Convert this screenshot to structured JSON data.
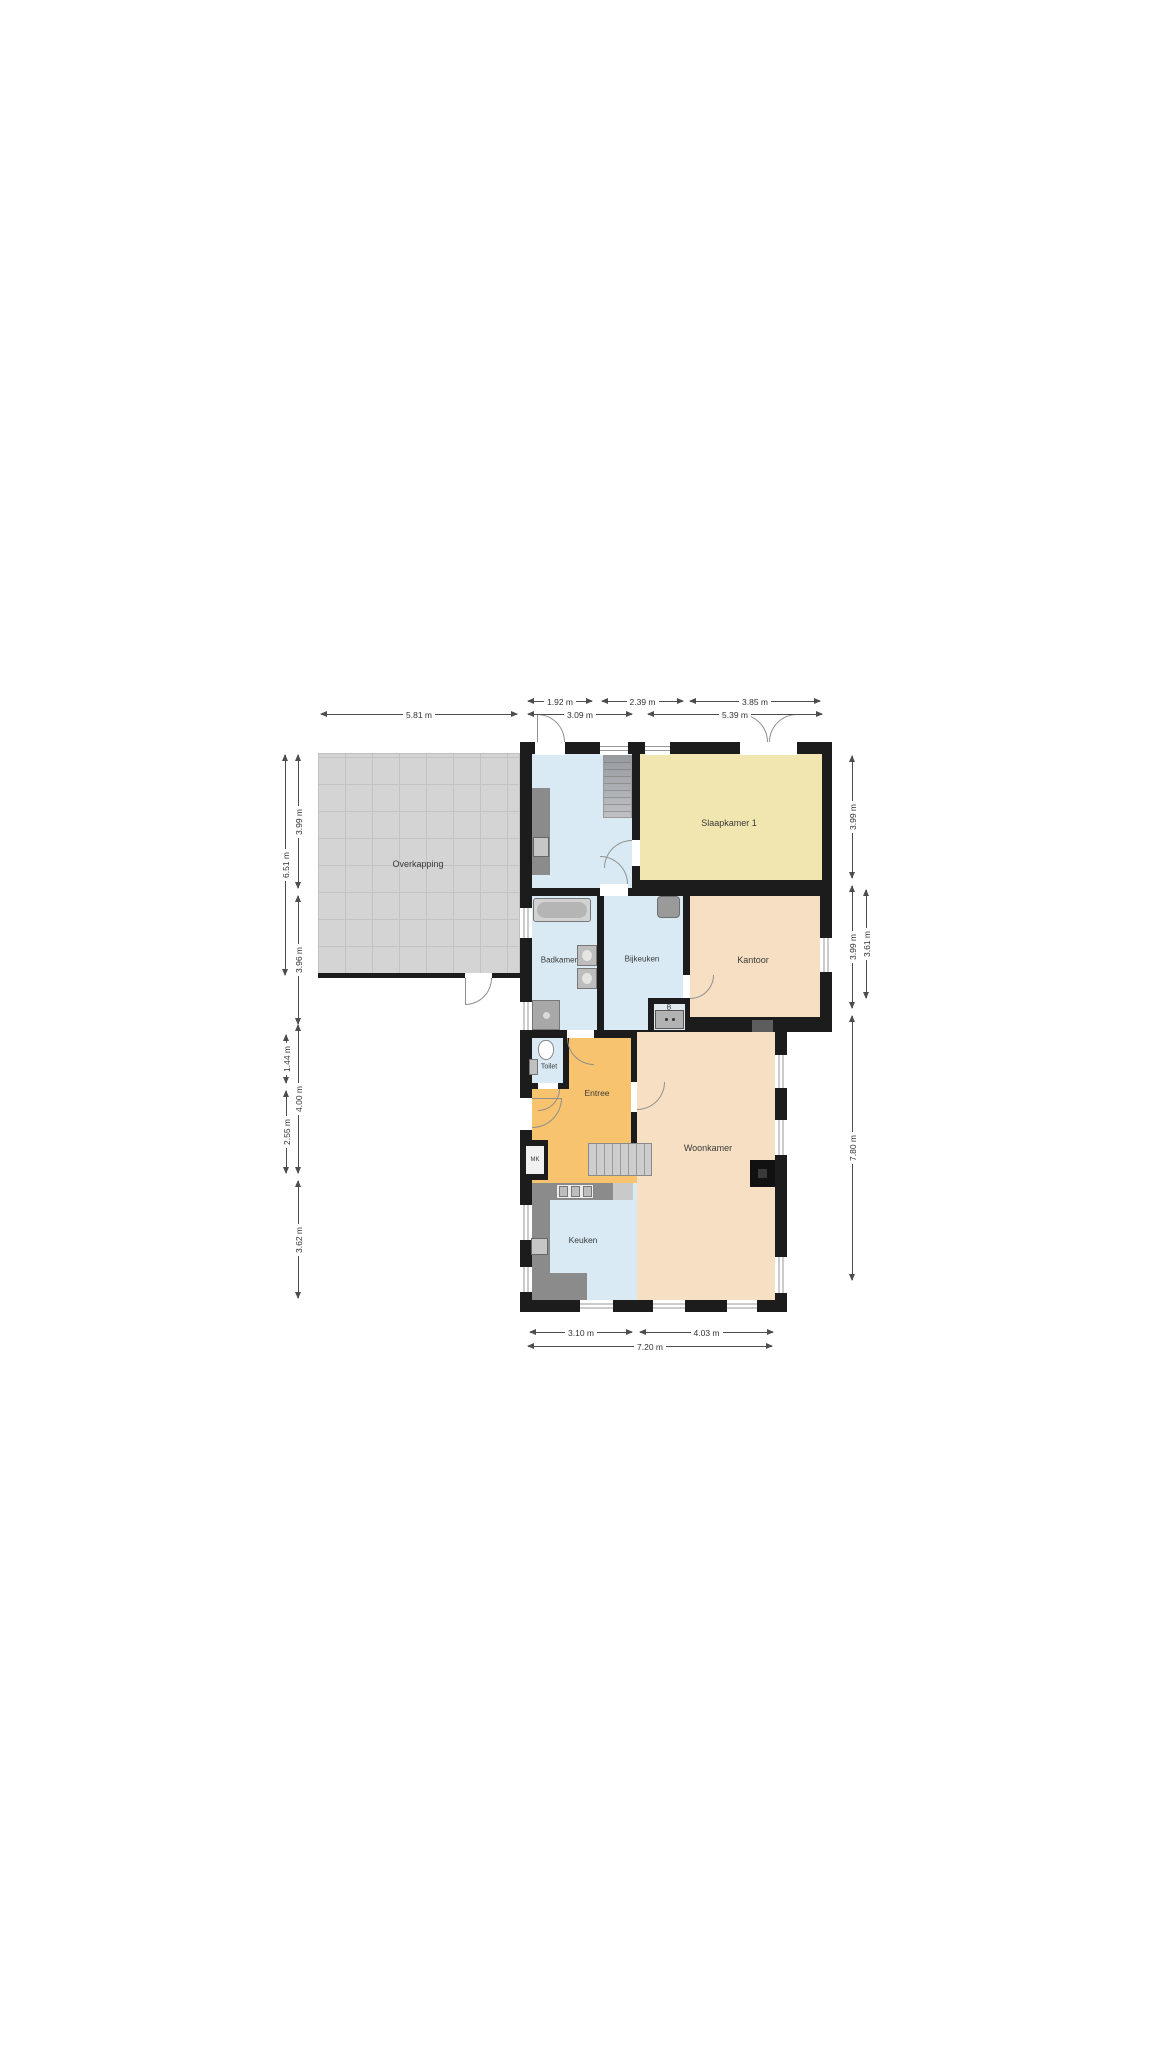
{
  "plan": {
    "type": "floorplan",
    "rooms": {
      "overkapping": {
        "label": "Overkapping"
      },
      "slaapkamer1": {
        "label": "Slaapkamer 1"
      },
      "badkamer": {
        "label": "Badkamer"
      },
      "bijkeuken": {
        "label": "Bijkeuken"
      },
      "kantoor": {
        "label": "Kantoor"
      },
      "toilet": {
        "label": "Toilet"
      },
      "entree": {
        "label": "Entree"
      },
      "woonkamer": {
        "label": "Woonkamer"
      },
      "keuken": {
        "label": "Keuken"
      },
      "mk": {
        "label": "MK"
      },
      "b": {
        "label": "B"
      }
    },
    "dims": {
      "top_row1": [
        "1.92 m",
        "2.39 m",
        "3.85 m"
      ],
      "top_row2": [
        "3.09 m",
        "5.39 m"
      ],
      "overkapping_width": "5.81 m",
      "left_upper_outer": "6.51 m",
      "left_upper_inner": [
        "3.99 m",
        "3.96 m"
      ],
      "left_lower_inner": [
        "1.44 m",
        "2.55 m"
      ],
      "left_lower_outer": [
        "4.00 m",
        "3.62 m"
      ],
      "right_outer": [
        "3.99 m",
        "3.99 m",
        "7.80 m"
      ],
      "right_inner": "3.61 m",
      "bottom_row1": [
        "3.10 m",
        "4.03 m"
      ],
      "bottom_total": "7.20 m"
    },
    "colors": {
      "wall": "#1c1c1c",
      "room_blue": "#d9eaf4",
      "room_yellow": "#f1e5b0",
      "room_peach": "#f6dfc2",
      "room_orange": "#f8c36e",
      "overkapping_grey": "#d4d4d4"
    }
  }
}
